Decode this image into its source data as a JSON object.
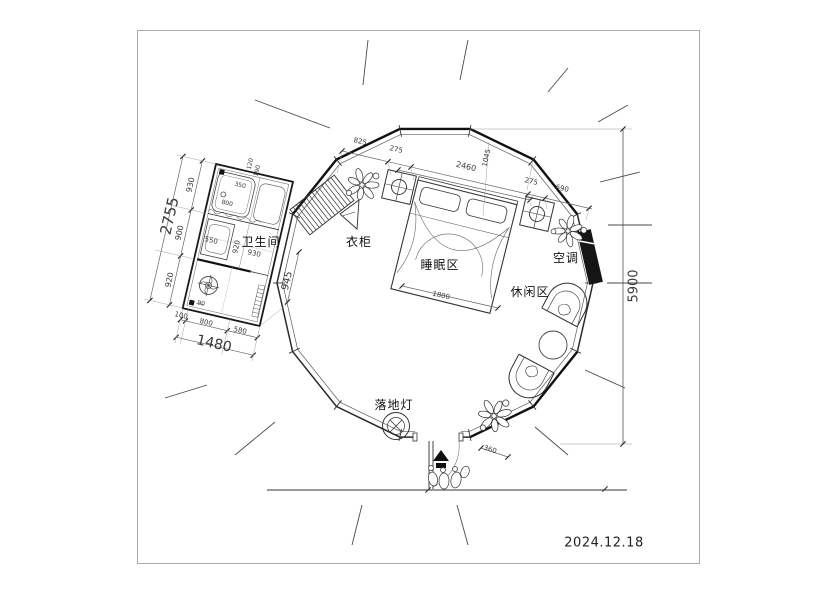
{
  "date": "2024.12.18",
  "rooms": {
    "bathroom": "卫生间",
    "wardrobe": "衣柜",
    "sleeping": "睡眠区",
    "leisure": "休闲区",
    "ac": "空调",
    "floor_lamp": "落地灯"
  },
  "dims": {
    "overall_height": "5900",
    "bath_left_total": "2755",
    "bath_left": [
      "930",
      "900",
      "920"
    ],
    "bath_bottom_total": "1480",
    "bath_bottom": [
      "100",
      "800",
      "580"
    ],
    "bath_right": "945",
    "bath_inner": {
      "sink": "550",
      "v": "920",
      "h": "930",
      "shower_w": "800",
      "shower_d": "350",
      "a": "120",
      "b": "190",
      "c": "90"
    },
    "top": {
      "a": "825",
      "b": "275",
      "span": "2460",
      "c": "1045",
      "d": "275",
      "e": "690"
    },
    "bed_width": "1800",
    "door": "360"
  }
}
